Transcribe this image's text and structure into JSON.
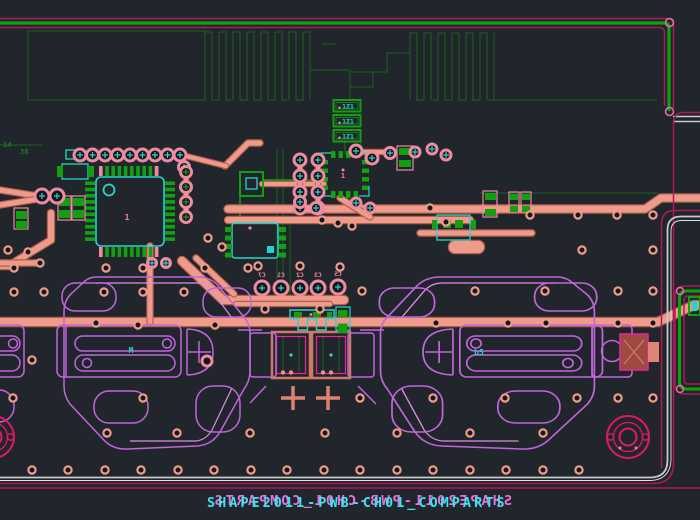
{
  "app": {
    "view_title": "PCB layout canvas"
  },
  "colors": {
    "background": "#20262c",
    "hole": "#14181d",
    "dim_green": "#1a631a",
    "dim_text": "#1f7a1f",
    "green": "#12a012",
    "cyan": "#29d3cb",
    "trace": "#ef9b8b",
    "trace_dark": "#b2604e",
    "pad_ring": "#ed8ba1",
    "pink": "#f585a8",
    "violet": "#c365dc",
    "magenta": "#b0185c",
    "magenta_bright": "#e8259c",
    "crimson": "#e01a62",
    "gray": "#c7c9cb",
    "text_cyan": "#3ae6ea",
    "text_magenta": "#ef6ee4"
  },
  "canvas": {
    "bottom_text_front": "SHAPE2011-PWB-CH01_COMPARTS",
    "bottom_text_back": "SHAPE2011-PWB-CH01_COMPARTS",
    "labels": [
      {
        "x": 3,
        "y": 147,
        "t": "14",
        "c": "#1f7a1f",
        "s": 7,
        "m": 0,
        "a": "start"
      },
      {
        "x": 20,
        "y": 154,
        "t": "38",
        "c": "#1f7a1f",
        "s": 7,
        "m": 0,
        "a": "start"
      },
      {
        "x": 127,
        "y": 220,
        "t": "1",
        "c": "#f585a8",
        "s": 8,
        "m": 0,
        "a": "middle"
      },
      {
        "x": 343,
        "y": 178,
        "t": "1",
        "c": "#f585a8",
        "s": 7,
        "m": 0,
        "a": "middle"
      },
      {
        "x": 131,
        "y": 353,
        "t": "M",
        "c": "#29d3cb",
        "s": 8,
        "m": 0,
        "a": "middle"
      },
      {
        "x": 479,
        "y": 355,
        "t": "b5",
        "c": "#29d3cb",
        "s": 8,
        "m": 0,
        "a": "middle"
      },
      {
        "x": 262,
        "y": 277,
        "t": "C7",
        "c": "#f585a8",
        "s": 6.5,
        "m": 1,
        "a": "middle"
      },
      {
        "x": 281,
        "y": 277,
        "t": "C1",
        "c": "#f585a8",
        "s": 6.5,
        "m": 1,
        "a": "middle"
      },
      {
        "x": 300,
        "y": 277,
        "t": "C2",
        "c": "#f585a8",
        "s": 6.5,
        "m": 1,
        "a": "middle"
      },
      {
        "x": 318,
        "y": 277,
        "t": "C3",
        "c": "#f585a8",
        "s": 6.5,
        "m": 1,
        "a": "middle"
      },
      {
        "x": 338,
        "y": 276,
        "t": "C5",
        "c": "#f585a8",
        "s": 6.5,
        "m": 1,
        "a": "middle"
      }
    ],
    "connectors": {
      "x": 333.5,
      "y0": 100,
      "w": 27,
      "h": 11.5,
      "pitch": 15,
      "count": 3,
      "text": "1Z1"
    },
    "qfp": {
      "bx": 96,
      "by": 177,
      "bw": 68,
      "bh": 69,
      "pins": 10,
      "pitch": 6.2,
      "pad_l": 10,
      "pad_w": 3.6,
      "refdes": "1"
    },
    "qfn": {
      "bx": 325,
      "by": 153,
      "bw": 40,
      "bh": 43,
      "side_pads": 4
    },
    "traces": [
      {
        "d": "M0,322 H658 L694,305 H700",
        "w": 8
      },
      {
        "d": "M228,209 H645 L661,198 H700",
        "w": 7
      },
      {
        "d": "M228,220 H470",
        "w": 6
      },
      {
        "d": "M420,233 H532",
        "w": 5
      },
      {
        "d": "M51,213 V240 L8,266 H0",
        "w": 6
      },
      {
        "d": "M150,246 V322",
        "w": 5
      },
      {
        "d": "M182,261 L223,300 H344",
        "w": 8
      },
      {
        "d": "M196,258 L234,294",
        "w": 5
      },
      {
        "d": "M236,304 H330",
        "w": 4
      },
      {
        "d": "M225,166 L248,143 H260",
        "w": 5
      },
      {
        "d": "M262,184 H324",
        "w": 4
      },
      {
        "d": "M340,198 L370,217",
        "w": 5
      },
      {
        "d": "M300,158 V210",
        "w": 4
      },
      {
        "d": "M318,158 V210",
        "w": 4
      },
      {
        "d": "M186,168 V218",
        "w": 4
      },
      {
        "d": "M78,155 H182",
        "w": 4
      },
      {
        "d": "M182,155 L226,166",
        "w": 4
      },
      {
        "d": "M0,190 L38,196",
        "w": 5
      },
      {
        "d": "M0,205 L38,199",
        "w": 5
      },
      {
        "d": "M362,152 H392",
        "w": 4
      },
      {
        "d": "M0,263 H40",
        "w": 5
      },
      {
        "d": "M455,247 H478",
        "w": 12
      }
    ],
    "dim_traces": [
      {
        "d": "M28,31 H205 V100 H28 Z",
        "w": 1
      },
      {
        "d": "M205,100 V32 H212 V100 H219 V32 H226 V100 H233 V32 H240 V100 H247 V32 H254 V100 H261 V32 H268 V100 H275 V32 H282 V100 H289 V32 H296 V100 H303 V32 H310 V100",
        "w": 1
      },
      {
        "d": "M310,70 H350 V100",
        "w": 1
      },
      {
        "d": "M322,44 H336",
        "w": 1
      },
      {
        "d": "M350,72 H387 V53 H410",
        "w": 1
      },
      {
        "d": "M350,72 V87 H373 V72",
        "w": 1
      },
      {
        "d": "M410,100 V33 H417 V100 H424 V33 H431 V100 H438 V33 H445 V100 H452 V33 H459 V100 H466 V33 H473 V100 H480 V33 H487 V100 H494 V33",
        "w": 1
      },
      {
        "d": "M494,100 H657",
        "w": 1
      },
      {
        "d": "M480,193 H658",
        "w": 1
      },
      {
        "d": "M0,145 H42",
        "w": 1
      },
      {
        "d": "M277,148 V298",
        "w": 1
      },
      {
        "d": "M283,148 V298",
        "w": 1
      },
      {
        "d": "M290,225 V298",
        "w": 1
      },
      {
        "d": "M277,298 H340",
        "w": 1
      },
      {
        "d": "M345,141 V151 Q345,156 350,156 H356 Q361,156 361,151 V141",
        "w": 1.2
      },
      {
        "d": "M283,337 V373",
        "w": 1
      },
      {
        "d": "M299,337 V373",
        "w": 1
      },
      {
        "d": "M323,337 V373",
        "w": 1
      },
      {
        "d": "M339,337 V373",
        "w": 1
      }
    ],
    "green_traces": [
      {
        "d": "M263,180 H324",
        "w": 1.5
      },
      {
        "d": "M240,196 V216",
        "w": 1.5
      }
    ],
    "vias": [
      [
        14,
        268
      ],
      [
        106,
        268
      ],
      [
        143,
        268
      ],
      [
        205,
        268
      ],
      [
        248,
        268
      ],
      [
        258,
        266
      ],
      [
        300,
        266
      ],
      [
        340,
        267
      ],
      [
        14,
        292
      ],
      [
        44,
        292
      ],
      [
        104,
        292
      ],
      [
        143,
        292
      ],
      [
        184,
        292
      ],
      [
        362,
        291
      ],
      [
        475,
        291
      ],
      [
        545,
        291
      ],
      [
        618,
        291
      ],
      [
        653,
        291
      ],
      [
        96,
        323
      ],
      [
        138,
        325
      ],
      [
        215,
        325
      ],
      [
        265,
        309
      ],
      [
        320,
        309
      ],
      [
        436,
        323
      ],
      [
        508,
        323
      ],
      [
        546,
        323
      ],
      [
        618,
        323
      ],
      [
        653,
        323
      ],
      [
        32,
        360
      ],
      [
        13,
        398
      ],
      [
        143,
        398
      ],
      [
        360,
        398
      ],
      [
        433,
        398
      ],
      [
        505,
        398
      ],
      [
        577,
        398
      ],
      [
        618,
        398
      ],
      [
        653,
        398
      ],
      [
        107,
        433
      ],
      [
        177,
        433
      ],
      [
        250,
        433
      ],
      [
        325,
        433
      ],
      [
        397,
        433
      ],
      [
        470,
        433
      ],
      [
        543,
        433
      ],
      [
        32,
        470
      ],
      [
        68,
        470
      ],
      [
        105,
        470
      ],
      [
        141,
        470
      ],
      [
        178,
        470
      ],
      [
        214,
        470
      ],
      [
        251,
        470
      ],
      [
        287,
        470
      ],
      [
        324,
        470
      ],
      [
        360,
        470
      ],
      [
        397,
        470
      ],
      [
        433,
        470
      ],
      [
        470,
        470
      ],
      [
        506,
        470
      ],
      [
        543,
        470
      ],
      [
        579,
        470
      ],
      [
        578,
        215
      ],
      [
        617,
        215
      ],
      [
        653,
        215
      ],
      [
        582,
        250
      ],
      [
        653,
        250
      ],
      [
        530,
        215
      ],
      [
        28,
        252
      ],
      [
        8,
        250
      ],
      [
        40,
        263
      ],
      [
        322,
        220
      ],
      [
        338,
        223
      ],
      [
        352,
        226
      ],
      [
        208,
        238
      ],
      [
        222,
        247
      ],
      [
        430,
        208
      ],
      [
        446,
        222
      ]
    ],
    "pads": [
      [
        80,
        155,
        6,
        "c"
      ],
      [
        92.5,
        155,
        6,
        "c"
      ],
      [
        105,
        155,
        6,
        "c"
      ],
      [
        117.5,
        155,
        6,
        "c"
      ],
      [
        130,
        155,
        6,
        "c"
      ],
      [
        142.5,
        155,
        6,
        "c"
      ],
      [
        155,
        155,
        6,
        "c"
      ],
      [
        167.5,
        155,
        6,
        "c"
      ],
      [
        180,
        155,
        6,
        "c"
      ],
      [
        184,
        167,
        5.5,
        "c"
      ],
      [
        42,
        196,
        7,
        "c"
      ],
      [
        57,
        196,
        7,
        "c"
      ],
      [
        186,
        172,
        5.5,
        "g"
      ],
      [
        186,
        187,
        5.5,
        "g"
      ],
      [
        186,
        202,
        5.5,
        "g"
      ],
      [
        186,
        217,
        5.5,
        "g"
      ],
      [
        300,
        160,
        6,
        "c"
      ],
      [
        300,
        176,
        6,
        "c"
      ],
      [
        300,
        192,
        6,
        "c"
      ],
      [
        300,
        208,
        6,
        "c"
      ],
      [
        318,
        160,
        6,
        "c"
      ],
      [
        318,
        176,
        6,
        "c"
      ],
      [
        318,
        192,
        6,
        "c"
      ],
      [
        318,
        208,
        6,
        "c"
      ],
      [
        356,
        151,
        6,
        "c"
      ],
      [
        372,
        158,
        6,
        "c"
      ],
      [
        390,
        153,
        5.5,
        "c"
      ],
      [
        415,
        152,
        5,
        "c"
      ],
      [
        432,
        149,
        5,
        "c"
      ],
      [
        446,
        155,
        5,
        "c"
      ],
      [
        262,
        288,
        7,
        "c"
      ],
      [
        281,
        288,
        7,
        "c"
      ],
      [
        300,
        288,
        7,
        "c"
      ],
      [
        318,
        288,
        7,
        "c"
      ],
      [
        338,
        287,
        7,
        "c"
      ],
      [
        300,
        202,
        5.5,
        "c"
      ],
      [
        316,
        208,
        5.5,
        "c"
      ],
      [
        356,
        203,
        5,
        "c"
      ],
      [
        370,
        208,
        5,
        "c"
      ],
      [
        207,
        361,
        5,
        "n"
      ],
      [
        152,
        263,
        4.5,
        "c"
      ],
      [
        166,
        263,
        4.5,
        "c"
      ]
    ],
    "rects": [
      [
        62,
        164,
        26,
        15,
        "cyan"
      ],
      [
        66,
        150,
        12,
        9,
        "cyan"
      ],
      [
        58,
        196,
        13,
        24,
        "pink"
      ],
      [
        72,
        196,
        13,
        24,
        "pink"
      ],
      [
        14,
        208,
        14,
        21,
        "pink"
      ],
      [
        246,
        178,
        11,
        11,
        "cyan"
      ],
      [
        240,
        172,
        23,
        24,
        "green"
      ],
      [
        437,
        215,
        33,
        25,
        "cyan"
      ],
      [
        483,
        191,
        14,
        26,
        "pink"
      ],
      [
        509,
        192,
        10,
        20,
        "pink"
      ],
      [
        521,
        192,
        10,
        20,
        "pink"
      ],
      [
        397,
        146,
        16,
        24,
        "pink"
      ]
    ],
    "frects": [
      [
        57,
        166,
        6,
        11,
        "g"
      ],
      [
        88,
        166,
        6,
        11,
        "g"
      ],
      [
        59,
        198,
        11,
        8,
        "g"
      ],
      [
        59,
        210,
        11,
        8,
        "g"
      ],
      [
        73,
        198,
        11,
        8,
        "g"
      ],
      [
        73,
        210,
        11,
        8,
        "g"
      ],
      [
        16,
        211,
        11,
        8,
        "g"
      ],
      [
        16,
        221,
        11,
        8,
        "g"
      ],
      [
        225,
        227,
        7,
        5,
        "g"
      ],
      [
        225,
        235.5,
        7,
        5,
        "g"
      ],
      [
        225,
        244,
        7,
        5,
        "g"
      ],
      [
        225,
        252.5,
        7,
        5,
        "g"
      ],
      [
        279,
        227,
        7,
        5,
        "g"
      ],
      [
        279,
        235.5,
        7,
        5,
        "g"
      ],
      [
        279,
        244,
        7,
        5,
        "g"
      ],
      [
        279,
        252.5,
        7,
        5,
        "g"
      ],
      [
        485,
        193,
        11,
        7,
        "g"
      ],
      [
        485,
        209,
        11,
        7,
        "g"
      ],
      [
        510,
        194,
        8,
        6,
        "g"
      ],
      [
        510,
        206,
        8,
        6,
        "g"
      ],
      [
        522,
        194,
        8,
        6,
        "g"
      ],
      [
        522,
        206,
        8,
        6,
        "g"
      ],
      [
        432,
        220,
        5,
        9,
        "g"
      ],
      [
        471,
        220,
        5,
        9,
        "g"
      ],
      [
        443,
        220,
        8,
        8,
        "g"
      ],
      [
        455,
        220,
        8,
        8,
        "g"
      ],
      [
        399,
        148,
        12,
        7,
        "g"
      ],
      [
        399,
        160,
        12,
        7,
        "g"
      ],
      [
        99,
        166,
        3.6,
        10,
        "p"
      ],
      [
        154.8,
        166,
        3.6,
        10,
        "p"
      ],
      [
        99,
        247,
        3.6,
        10,
        "p"
      ],
      [
        154.8,
        247,
        3.6,
        10,
        "p"
      ]
    ]
  }
}
